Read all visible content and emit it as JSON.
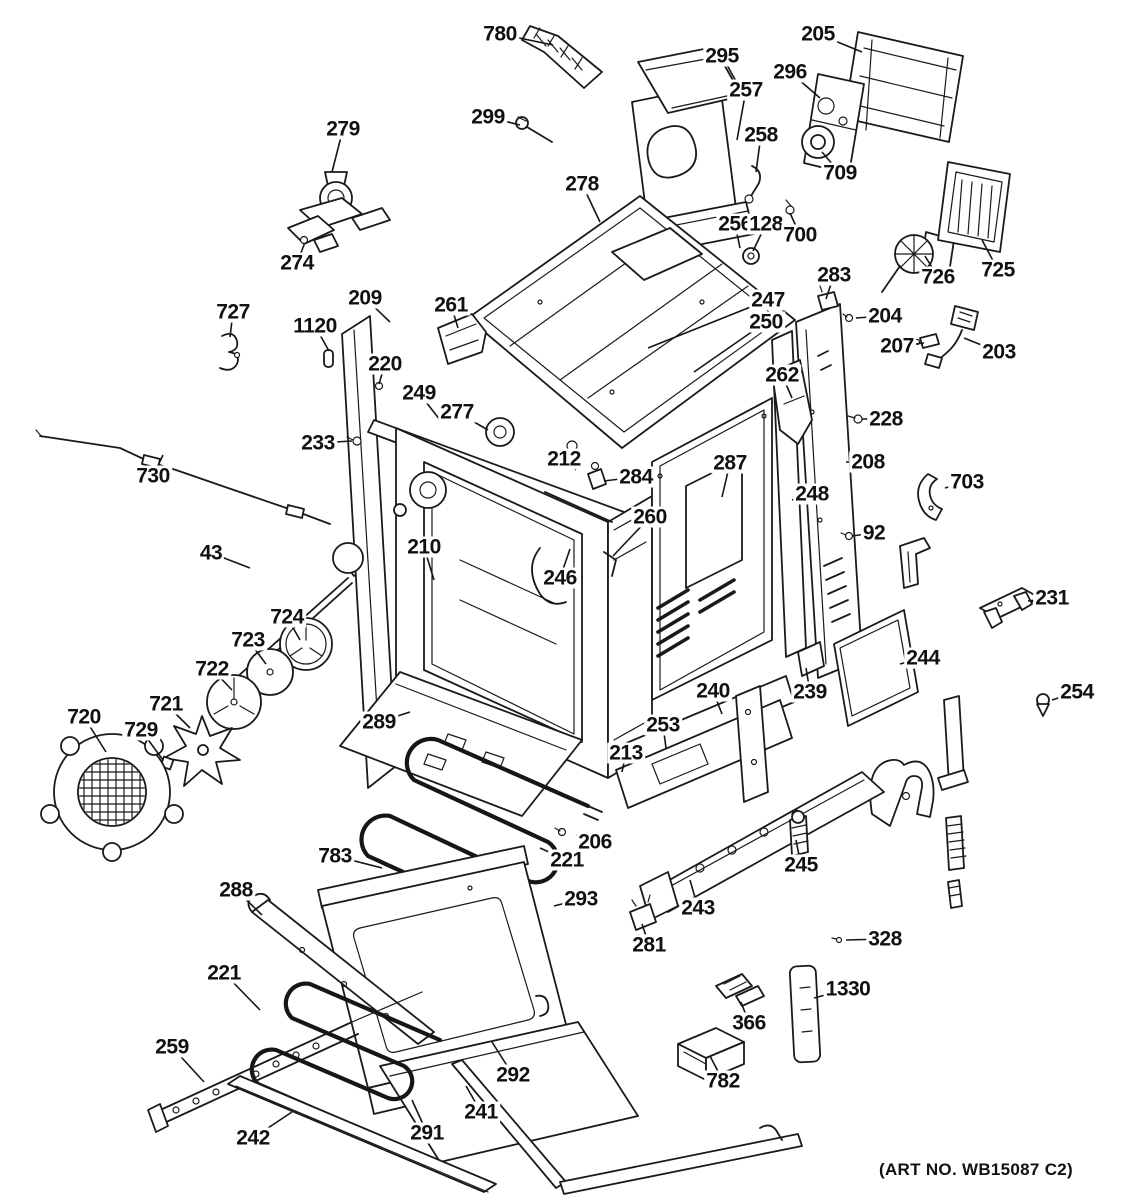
{
  "diagram": {
    "art_no": "(ART NO. WB15087 C2)",
    "background": "#ffffff",
    "line_color": "#1a1a1a",
    "labels": [
      {
        "text": "780",
        "x": 500,
        "y": 34,
        "tx": 553,
        "ty": 45
      },
      {
        "text": "295",
        "x": 722,
        "y": 56,
        "tx": 742,
        "ty": 92
      },
      {
        "text": "205",
        "x": 818,
        "y": 34,
        "tx": 862,
        "ty": 52
      },
      {
        "text": "296",
        "x": 790,
        "y": 72,
        "tx": 820,
        "ty": 98
      },
      {
        "text": "257",
        "x": 746,
        "y": 90,
        "tx": 737,
        "ty": 140
      },
      {
        "text": "299",
        "x": 488,
        "y": 117,
        "tx": 520,
        "ty": 125
      },
      {
        "text": "258",
        "x": 761,
        "y": 135,
        "tx": 756,
        "ty": 172
      },
      {
        "text": "279",
        "x": 343,
        "y": 129,
        "tx": 332,
        "ty": 172
      },
      {
        "text": "709",
        "x": 840,
        "y": 173,
        "tx": 822,
        "ty": 152
      },
      {
        "text": "278",
        "x": 582,
        "y": 184,
        "tx": 600,
        "ty": 222
      },
      {
        "text": "256",
        "x": 735,
        "y": 224,
        "tx": 740,
        "ty": 248
      },
      {
        "text": "128",
        "x": 766,
        "y": 224,
        "tx": 753,
        "ty": 251
      },
      {
        "text": "700",
        "x": 800,
        "y": 235,
        "tx": 790,
        "ty": 213
      },
      {
        "text": "726",
        "x": 938,
        "y": 277,
        "tx": 925,
        "ty": 256
      },
      {
        "text": "725",
        "x": 998,
        "y": 270,
        "tx": 982,
        "ty": 240
      },
      {
        "text": "274",
        "x": 297,
        "y": 263,
        "tx": 304,
        "ty": 245
      },
      {
        "text": "283",
        "x": 834,
        "y": 275,
        "tx": 826,
        "ty": 299
      },
      {
        "text": "209",
        "x": 365,
        "y": 298,
        "tx": 390,
        "ty": 322
      },
      {
        "text": "261",
        "x": 451,
        "y": 305,
        "tx": 458,
        "ty": 328
      },
      {
        "text": "247",
        "x": 768,
        "y": 300,
        "tx": 648,
        "ty": 348
      },
      {
        "text": "204",
        "x": 885,
        "y": 316,
        "tx": 856,
        "ty": 318
      },
      {
        "text": "1120",
        "x": 315,
        "y": 326,
        "tx": 329,
        "ty": 351
      },
      {
        "text": "250",
        "x": 766,
        "y": 322,
        "tx": 694,
        "ty": 372
      },
      {
        "text": "207",
        "x": 897,
        "y": 346,
        "tx": 924,
        "ty": 343
      },
      {
        "text": "203",
        "x": 999,
        "y": 352,
        "tx": 964,
        "ty": 338
      },
      {
        "text": "727",
        "x": 233,
        "y": 312,
        "tx": 230,
        "ty": 337
      },
      {
        "text": "220",
        "x": 385,
        "y": 364,
        "tx": 379,
        "ty": 384
      },
      {
        "text": "262",
        "x": 782,
        "y": 375,
        "tx": 792,
        "ty": 398
      },
      {
        "text": "249",
        "x": 419,
        "y": 393,
        "tx": 440,
        "ty": 420
      },
      {
        "text": "228",
        "x": 886,
        "y": 419,
        "tx": 862,
        "ty": 419
      },
      {
        "text": "277",
        "x": 457,
        "y": 412,
        "tx": 488,
        "ty": 430
      },
      {
        "text": "233",
        "x": 318,
        "y": 443,
        "tx": 352,
        "ty": 441
      },
      {
        "text": "212",
        "x": 564,
        "y": 459,
        "tx": 576,
        "ty": 470
      },
      {
        "text": "284",
        "x": 636,
        "y": 477,
        "tx": 604,
        "ty": 481
      },
      {
        "text": "287",
        "x": 730,
        "y": 463,
        "tx": 722,
        "ty": 497
      },
      {
        "text": "208",
        "x": 868,
        "y": 462,
        "tx": 846,
        "ty": 462
      },
      {
        "text": "730",
        "x": 153,
        "y": 476,
        "tx": 163,
        "ty": 455
      },
      {
        "text": "703",
        "x": 967,
        "y": 482,
        "tx": 945,
        "ty": 488
      },
      {
        "text": "248",
        "x": 812,
        "y": 494,
        "tx": 792,
        "ty": 500
      },
      {
        "text": "260",
        "x": 650,
        "y": 517,
        "tx": 613,
        "ty": 556
      },
      {
        "text": "92",
        "x": 874,
        "y": 533,
        "tx": 852,
        "ty": 536
      },
      {
        "text": "43",
        "x": 211,
        "y": 553,
        "tx": 250,
        "ty": 568
      },
      {
        "text": "210",
        "x": 424,
        "y": 547,
        "tx": 434,
        "ty": 580
      },
      {
        "text": "246",
        "x": 560,
        "y": 578,
        "tx": 570,
        "ty": 549
      },
      {
        "text": "231",
        "x": 1052,
        "y": 598,
        "tx": 1028,
        "ty": 601
      },
      {
        "text": "724",
        "x": 287,
        "y": 617,
        "tx": 300,
        "ty": 640
      },
      {
        "text": "723",
        "x": 248,
        "y": 640,
        "tx": 266,
        "ty": 664
      },
      {
        "text": "722",
        "x": 212,
        "y": 669,
        "tx": 232,
        "ty": 690
      },
      {
        "text": "244",
        "x": 923,
        "y": 658,
        "tx": 900,
        "ty": 664
      },
      {
        "text": "721",
        "x": 166,
        "y": 704,
        "tx": 190,
        "ty": 728
      },
      {
        "text": "720",
        "x": 84,
        "y": 717,
        "tx": 106,
        "ty": 752
      },
      {
        "text": "729",
        "x": 141,
        "y": 730,
        "tx": 163,
        "ty": 760
      },
      {
        "text": "240",
        "x": 713,
        "y": 691,
        "tx": 722,
        "ty": 714
      },
      {
        "text": "239",
        "x": 810,
        "y": 692,
        "tx": 806,
        "ty": 668
      },
      {
        "text": "289",
        "x": 379,
        "y": 722,
        "tx": 410,
        "ty": 712
      },
      {
        "text": "253",
        "x": 663,
        "y": 725,
        "tx": 666,
        "ty": 748
      },
      {
        "text": "213",
        "x": 626,
        "y": 753,
        "tx": 622,
        "ty": 772
      },
      {
        "text": "254",
        "x": 1077,
        "y": 692,
        "tx": 1052,
        "ty": 700
      },
      {
        "text": "245",
        "x": 801,
        "y": 865,
        "tx": 796,
        "ty": 840
      },
      {
        "text": "206",
        "x": 595,
        "y": 842,
        "tx": 576,
        "ty": 835
      },
      {
        "text": "221",
        "x": 567,
        "y": 860,
        "tx": 540,
        "ty": 848
      },
      {
        "text": "783",
        "x": 335,
        "y": 856,
        "tx": 382,
        "ty": 868
      },
      {
        "text": "288",
        "x": 236,
        "y": 890,
        "tx": 262,
        "ty": 915
      },
      {
        "text": "293",
        "x": 581,
        "y": 899,
        "tx": 554,
        "ty": 906
      },
      {
        "text": "243",
        "x": 698,
        "y": 908,
        "tx": 690,
        "ty": 880
      },
      {
        "text": "281",
        "x": 649,
        "y": 945,
        "tx": 642,
        "ty": 924
      },
      {
        "text": "328",
        "x": 885,
        "y": 939,
        "tx": 846,
        "ty": 940
      },
      {
        "text": "1330",
        "x": 848,
        "y": 989,
        "tx": 814,
        "ty": 998
      },
      {
        "text": "366",
        "x": 749,
        "y": 1023,
        "tx": 741,
        "ty": 1002
      },
      {
        "text": "221",
        "x": 224,
        "y": 973,
        "tx": 260,
        "ty": 1010
      },
      {
        "text": "259",
        "x": 172,
        "y": 1047,
        "tx": 204,
        "ty": 1082
      },
      {
        "text": "782",
        "x": 723,
        "y": 1081,
        "tx": 710,
        "ty": 1056
      },
      {
        "text": "292",
        "x": 513,
        "y": 1075,
        "tx": 492,
        "ty": 1042
      },
      {
        "text": "241",
        "x": 481,
        "y": 1112,
        "tx": 466,
        "ty": 1086
      },
      {
        "text": "242",
        "x": 253,
        "y": 1138,
        "tx": 292,
        "ty": 1112
      },
      {
        "text": "291",
        "x": 427,
        "y": 1133,
        "tx": 412,
        "ty": 1100
      }
    ]
  }
}
